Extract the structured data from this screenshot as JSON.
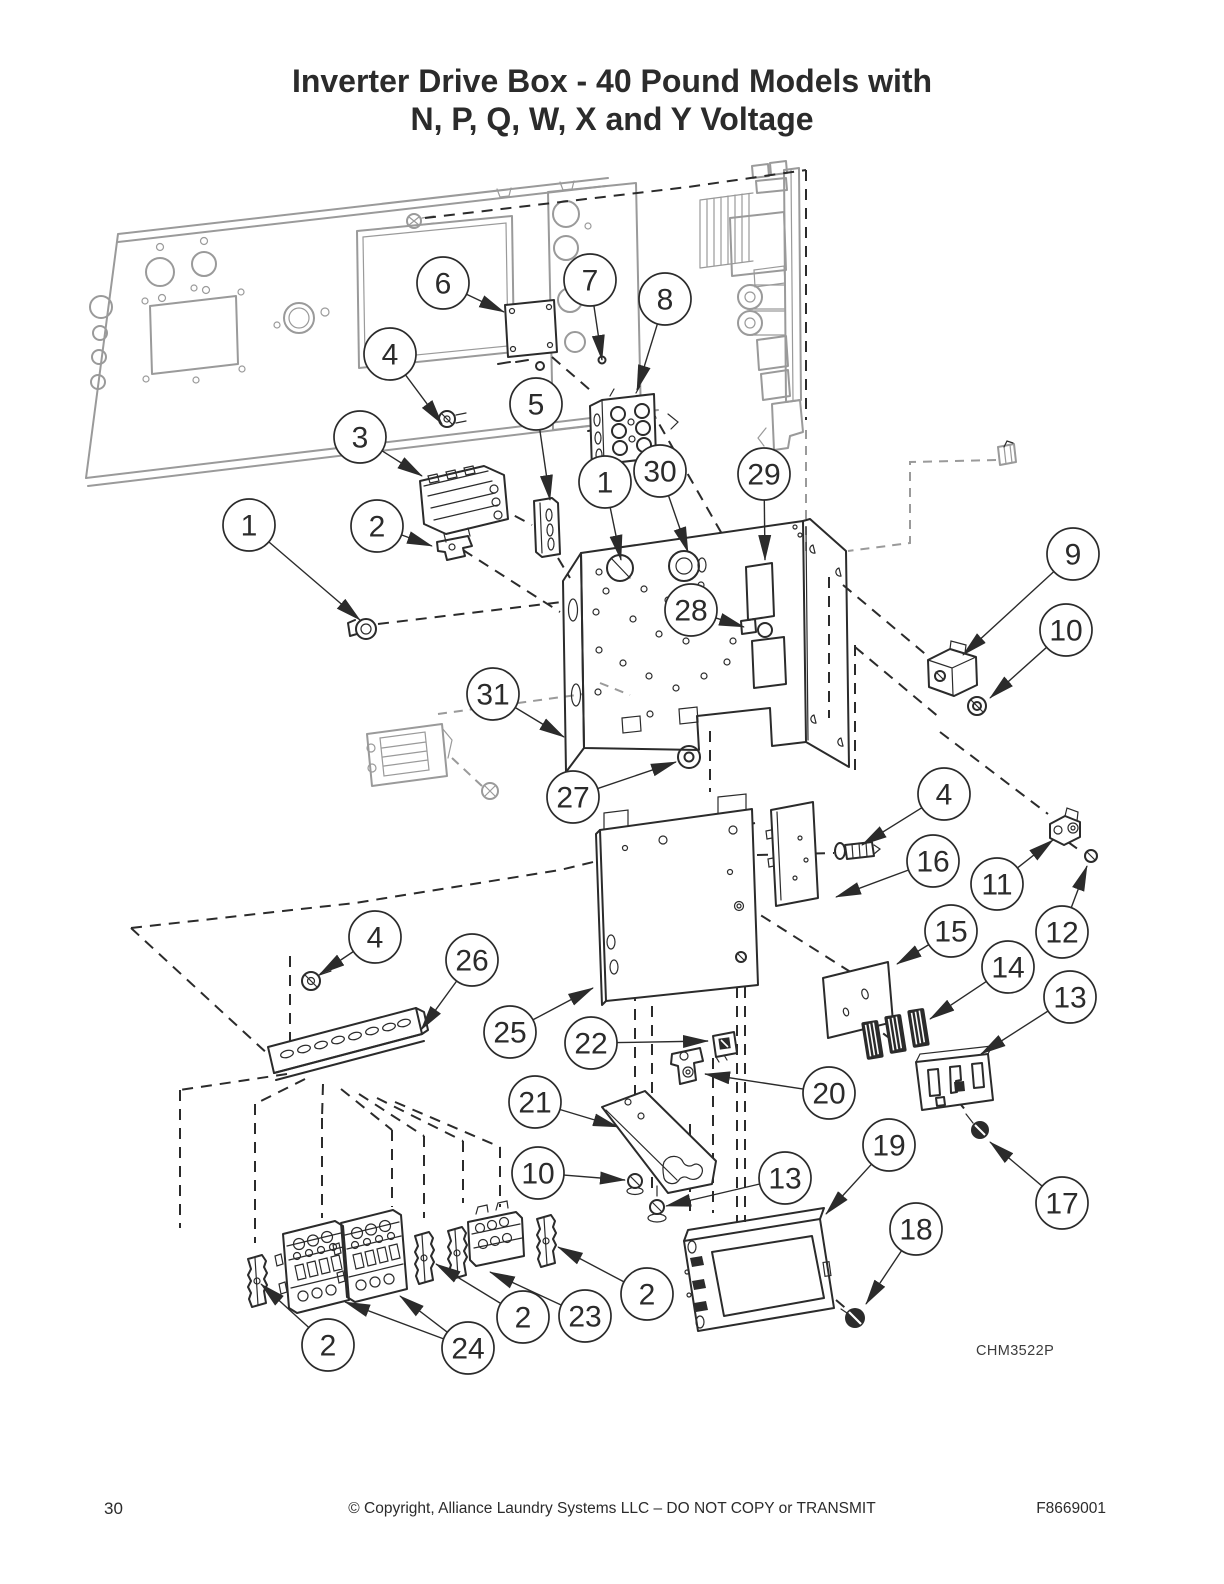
{
  "page": {
    "title_line1": "Inverter Drive Box - 40 Pound Models with",
    "title_line2": "N, P, Q, W, X and Y Voltage",
    "figure_code": "CHM3522P",
    "footer": {
      "page_number": "30",
      "copyright": "© Copyright, Alliance Laundry Systems LLC – DO NOT COPY or TRANSMIT",
      "document_number": "F8669001"
    }
  },
  "colors": {
    "ink": "#2b2b2b",
    "gray": "#9a9a9a",
    "paper": "#ffffff"
  },
  "diagram": {
    "type": "exploded-parts-diagram",
    "callouts": [
      {
        "label": "6",
        "x": 443,
        "y": 283,
        "targets": [
          [
            504,
            312
          ]
        ]
      },
      {
        "label": "7",
        "x": 590,
        "y": 280,
        "targets": [
          [
            602,
            360
          ]
        ]
      },
      {
        "label": "8",
        "x": 665,
        "y": 299,
        "targets": [
          [
            637,
            390
          ]
        ]
      },
      {
        "label": "4",
        "x": 390,
        "y": 354,
        "targets": [
          [
            442,
            424
          ]
        ]
      },
      {
        "label": "3",
        "x": 360,
        "y": 437,
        "targets": [
          [
            422,
            476
          ]
        ]
      },
      {
        "label": "5",
        "x": 536,
        "y": 404,
        "targets": [
          [
            550,
            500
          ]
        ]
      },
      {
        "label": "1",
        "x": 605,
        "y": 482,
        "targets": [
          [
            621,
            560
          ]
        ]
      },
      {
        "label": "30",
        "x": 660,
        "y": 471,
        "targets": [
          [
            688,
            552
          ]
        ]
      },
      {
        "label": "29",
        "x": 764,
        "y": 474,
        "targets": [
          [
            765,
            560
          ]
        ]
      },
      {
        "label": "1",
        "x": 249,
        "y": 525,
        "targets": [
          [
            360,
            620
          ]
        ]
      },
      {
        "label": "2",
        "x": 377,
        "y": 526,
        "targets": [
          [
            432,
            546
          ]
        ]
      },
      {
        "label": "28",
        "x": 691,
        "y": 610,
        "targets": [
          [
            744,
            627
          ]
        ]
      },
      {
        "label": "9",
        "x": 1073,
        "y": 554,
        "targets": [
          [
            963,
            655
          ]
        ]
      },
      {
        "label": "10",
        "x": 1066,
        "y": 630,
        "targets": [
          [
            990,
            698
          ]
        ]
      },
      {
        "label": "31",
        "x": 493,
        "y": 694,
        "targets": [
          [
            564,
            737
          ]
        ]
      },
      {
        "label": "27",
        "x": 573,
        "y": 797,
        "targets": [
          [
            676,
            762
          ]
        ]
      },
      {
        "label": "4",
        "x": 944,
        "y": 794,
        "targets": [
          [
            862,
            845
          ]
        ]
      },
      {
        "label": "16",
        "x": 933,
        "y": 861,
        "targets": [
          [
            836,
            897
          ]
        ]
      },
      {
        "label": "11",
        "x": 997,
        "y": 884,
        "targets": [
          [
            1053,
            840
          ]
        ]
      },
      {
        "label": "12",
        "x": 1062,
        "y": 932,
        "targets": [
          [
            1087,
            866
          ]
        ]
      },
      {
        "label": "15",
        "x": 951,
        "y": 931,
        "targets": [
          [
            897,
            964
          ]
        ]
      },
      {
        "label": "14",
        "x": 1008,
        "y": 967,
        "targets": [
          [
            930,
            1019
          ]
        ]
      },
      {
        "label": "13",
        "x": 1070,
        "y": 997,
        "targets": [
          [
            981,
            1054
          ]
        ]
      },
      {
        "label": "4",
        "x": 375,
        "y": 937,
        "targets": [
          [
            320,
            974
          ]
        ]
      },
      {
        "label": "26",
        "x": 472,
        "y": 960,
        "targets": [
          [
            421,
            1030
          ]
        ]
      },
      {
        "label": "25",
        "x": 510,
        "y": 1032,
        "targets": [
          [
            593,
            988
          ]
        ]
      },
      {
        "label": "22",
        "x": 591,
        "y": 1043,
        "targets": [
          [
            708,
            1041
          ]
        ]
      },
      {
        "label": "21",
        "x": 535,
        "y": 1102,
        "targets": [
          [
            618,
            1127
          ]
        ]
      },
      {
        "label": "20",
        "x": 829,
        "y": 1093,
        "targets": [
          [
            705,
            1074
          ]
        ]
      },
      {
        "label": "10",
        "x": 538,
        "y": 1173,
        "targets": [
          [
            625,
            1180
          ]
        ]
      },
      {
        "label": "13",
        "x": 785,
        "y": 1178,
        "targets": [
          [
            666,
            1206
          ]
        ]
      },
      {
        "label": "19",
        "x": 889,
        "y": 1145,
        "targets": [
          [
            826,
            1214
          ]
        ]
      },
      {
        "label": "17",
        "x": 1062,
        "y": 1203,
        "targets": [
          [
            990,
            1142
          ]
        ]
      },
      {
        "label": "18",
        "x": 916,
        "y": 1229,
        "targets": [
          [
            866,
            1304
          ]
        ]
      },
      {
        "label": "2",
        "x": 328,
        "y": 1345,
        "targets": [
          [
            261,
            1284
          ]
        ]
      },
      {
        "label": "24",
        "x": 468,
        "y": 1348,
        "targets": [
          [
            345,
            1302
          ],
          [
            400,
            1296
          ]
        ]
      },
      {
        "label": "2",
        "x": 523,
        "y": 1317,
        "targets": [
          [
            436,
            1264
          ]
        ]
      },
      {
        "label": "23",
        "x": 585,
        "y": 1316,
        "targets": [
          [
            490,
            1272
          ]
        ]
      },
      {
        "label": "2",
        "x": 647,
        "y": 1294,
        "targets": [
          [
            558,
            1247
          ]
        ]
      }
    ]
  }
}
